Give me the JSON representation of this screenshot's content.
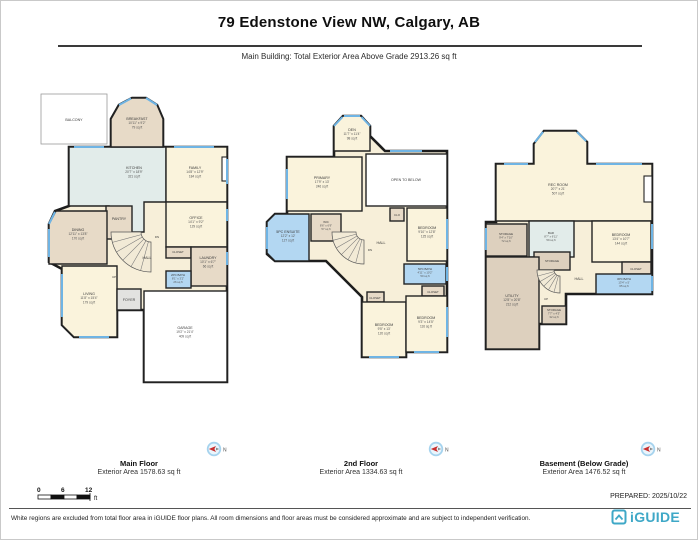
{
  "header": {
    "title": "79 Edenstone View NW, Calgary, AB",
    "subtitle": "Main Building: Total Exterior Area Above Grade 2913.26 sq ft"
  },
  "compass": {
    "label": "N"
  },
  "scale": {
    "ticks": [
      "0",
      "6",
      "12"
    ],
    "unit": "ft"
  },
  "footer": {
    "prepared": "PREPARED: 2025/10/22",
    "disclaimer": "White regions are excluded from total floor area in iGUIDE floor plans. All room dimensions and floor areas must be considered approximate and are subject to independent verification.",
    "logo": "iGUIDE"
  },
  "colors": {
    "wall": "#1d1d1d",
    "window": "#6fb4e4",
    "room_cream": "#faf3dc",
    "room_beige": "#e7dac7",
    "room_bath_blue": "#b3d7f2",
    "room_kitchen_teal": "#e2ecea",
    "logo_teal": "#3fa8c7"
  },
  "floors": [
    {
      "name": "Main Floor",
      "area_label": "Exterior Area 1578.63 sq ft",
      "rooms": [
        {
          "name": "BALCONY"
        },
        {
          "name": "BREAKFAST",
          "dims": "10'11\" x 9'2\"",
          "area": "79 sq ft"
        },
        {
          "name": "KITCHEN",
          "dims": "20'7\" x 18'9\"",
          "area": "321 sq ft"
        },
        {
          "name": "FAMILY",
          "dims": "14'8\" x 12'9\"",
          "area": "184 sq ft"
        },
        {
          "name": "DINING",
          "dims": "12'11\" x 13'8\"",
          "area": "170 sq ft"
        },
        {
          "name": "PANTRY"
        },
        {
          "name": "OFFICE",
          "dims": "14'1\" x 9'2\"",
          "area": "129 sq ft"
        },
        {
          "name": "CLOSET"
        },
        {
          "name": "LAUNDRY",
          "dims": "10'1\" x 6'7\"",
          "area": "66 sq ft"
        },
        {
          "name": "2PC BATH",
          "dims": "8'1\" x 3'2\"",
          "area": "26 sq ft"
        },
        {
          "name": "HALL"
        },
        {
          "name": "LIVING",
          "dims": "11'8\" x 15'4\"",
          "area": "179 sq ft"
        },
        {
          "name": "FOYER"
        },
        {
          "name": "GARAGE",
          "dims": "19'2\" x 21'4\"",
          "area": "409 sq ft"
        },
        {
          "name": "DN"
        },
        {
          "name": "UP"
        }
      ]
    },
    {
      "name": "2nd Floor",
      "area_label": "Exterior Area 1334.63 sq ft",
      "rooms": [
        {
          "name": "DEN",
          "dims": "11'7\" x 11'4\"",
          "area": "98 sq ft"
        },
        {
          "name": "PRIMARY",
          "dims": "17'9\" x 13'",
          "area": "246 sq ft"
        },
        {
          "name": "OPEN TO BELOW"
        },
        {
          "name": "5PC ENSUITE",
          "dims": "12'2\" x 12'",
          "area": "127 sq ft"
        },
        {
          "name": "WIC",
          "dims": "8'6\" x 6'9\"",
          "area": "57 sq ft"
        },
        {
          "name": "CLO"
        },
        {
          "name": "BEDROOM",
          "dims": "9'10\" x 12'8\"",
          "area": "125 sq ft"
        },
        {
          "name": "5PC BATH",
          "dims": "4'11\" x 10'2\"",
          "area": "50 sq ft"
        },
        {
          "name": "CLOSET"
        },
        {
          "name": "CLOSET"
        },
        {
          "name": "BEDROOM",
          "dims": "9'5\" x 13'",
          "area": "120 sq ft"
        },
        {
          "name": "BEDROOM",
          "dims": "9'3\" x 14'5\"",
          "area": "116 sq ft"
        },
        {
          "name": "HALL"
        },
        {
          "name": "DN"
        }
      ]
    },
    {
      "name": "Basement (Below Grade)",
      "area_label": "Exterior Area 1476.52 sq ft",
      "rooms": [
        {
          "name": "REC ROOM",
          "dims": "20'7\" x 21'",
          "area": "507 sq ft"
        },
        {
          "name": "STORAGE",
          "dims": "9'4\" x 7'10\"",
          "area": "72 sq ft"
        },
        {
          "name": "BAR",
          "dims": "8'7\" x 6'11\"",
          "area": "59 sq ft"
        },
        {
          "name": "BEDROOM",
          "dims": "13'4\" x 10'7\"",
          "area": "144 sq ft"
        },
        {
          "name": "CLOSET"
        },
        {
          "name": "3PC BATH",
          "dims": "13'4\" x 5'",
          "area": "65 sq ft"
        },
        {
          "name": "STORAGE"
        },
        {
          "name": "UTILITY",
          "dims": "12'8\" x 20'8\"",
          "area": "212 sq ft"
        },
        {
          "name": "STORAGE",
          "dims": "7'7\" x 4'3\"",
          "area": "32 sq ft"
        },
        {
          "name": "HALL"
        },
        {
          "name": "UP"
        }
      ]
    }
  ]
}
